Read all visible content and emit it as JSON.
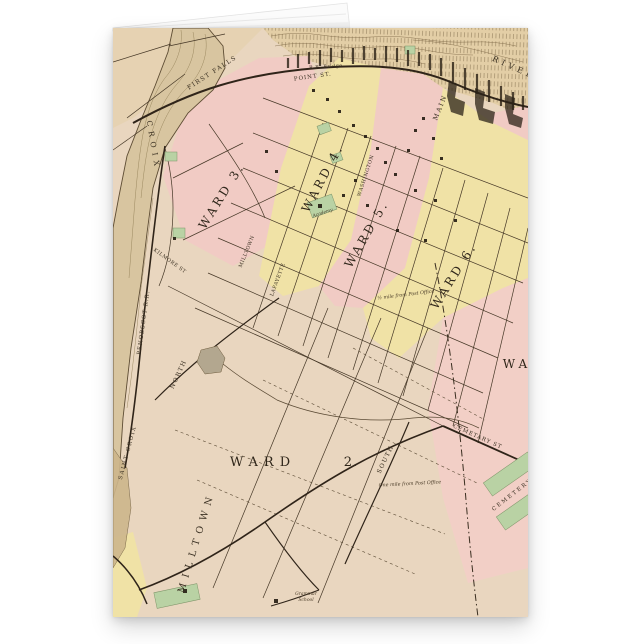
{
  "background_color": "#ffffff",
  "map": {
    "palette": {
      "parchment": "#e9d6bf",
      "river_tan": "#d8c5a0",
      "ward_pink": "#f1cbc4",
      "ward_yellow": "#f0e2a6",
      "park_green": "#b9d2a4",
      "hillside": "#e3cea6",
      "ink": "#3a2e20"
    },
    "ward_labels": [
      {
        "text": "WARD 3.",
        "x": 112,
        "y": 170,
        "rot": -58,
        "size": 12,
        "ls": 3
      },
      {
        "text": "WARD 4.",
        "x": 213,
        "y": 152,
        "rot": -62,
        "size": 12,
        "ls": 3
      },
      {
        "text": "WARD 5.",
        "x": 257,
        "y": 208,
        "rot": -60,
        "size": 12,
        "ls": 3
      },
      {
        "text": "WARD 6.",
        "x": 344,
        "y": 250,
        "rot": -58,
        "size": 12,
        "ls": 3
      },
      {
        "text": "WARD",
        "x": 150,
        "y": 438,
        "rot": 0,
        "size": 13,
        "ls": 6
      },
      {
        "text": "2.",
        "x": 238,
        "y": 438,
        "rot": 0,
        "size": 13,
        "ls": 1
      },
      {
        "text": "WA",
        "x": 404,
        "y": 340,
        "rot": 0,
        "size": 12,
        "ls": 4
      }
    ],
    "street_labels": [
      {
        "text": "CROIX",
        "x": 38,
        "y": 118,
        "rot": 80,
        "size": 7.5,
        "ls": 5
      },
      {
        "text": "SAINT CROIX",
        "x": 16,
        "y": 425,
        "rot": -75,
        "size": 5.5,
        "ls": 1.5
      },
      {
        "text": "PENOBSCOT R.R.",
        "x": 32,
        "y": 295,
        "rot": -82,
        "size": 5.5,
        "ls": 1
      },
      {
        "text": "FIRST FALLS",
        "x": 100,
        "y": 46,
        "rot": -33,
        "size": 6,
        "ls": 1.5
      },
      {
        "text": "RIVER",
        "x": 400,
        "y": 42,
        "rot": 24,
        "size": 8,
        "ls": 4
      },
      {
        "text": "POINT ST.",
        "x": 200,
        "y": 50,
        "rot": -8,
        "size": 5.5,
        "ls": 1
      },
      {
        "text": "MAIN",
        "x": 329,
        "y": 80,
        "rot": -68,
        "size": 6.5,
        "ls": 2
      },
      {
        "text": "WASHINGTON",
        "x": 254,
        "y": 148,
        "rot": -72,
        "size": 5,
        "ls": 0.5
      },
      {
        "text": "LAFAYETTE",
        "x": 166,
        "y": 252,
        "rot": -70,
        "size": 5,
        "ls": 0.5
      },
      {
        "text": "MILLTOWN",
        "x": 135,
        "y": 224,
        "rot": -68,
        "size": 5,
        "ls": 0.5
      },
      {
        "text": "KILMORE ST",
        "x": 56,
        "y": 234,
        "rot": 36,
        "size": 5,
        "ls": 0.5
      },
      {
        "text": "NORTH",
        "x": 67,
        "y": 347,
        "rot": -65,
        "size": 6,
        "ls": 1.5
      },
      {
        "text": "SOUTH",
        "x": 274,
        "y": 432,
        "rot": -64,
        "size": 6,
        "ls": 1.5
      },
      {
        "text": "MILLTOWN",
        "x": 86,
        "y": 515,
        "rot": -73,
        "size": 9.5,
        "ls": 6
      },
      {
        "text": "CEMETARY ST",
        "x": 364,
        "y": 410,
        "rot": 24,
        "size": 5.5,
        "ls": 1
      },
      {
        "text": "CEMETERY",
        "x": 400,
        "y": 468,
        "rot": -38,
        "size": 5.5,
        "ls": 2
      },
      {
        "text": "R.R. Bridge",
        "x": 213,
        "y": 40,
        "rot": -4,
        "size": 4.8,
        "ls": 0.5
      }
    ],
    "annotation_labels": [
      {
        "text": "½ mile from Post Office",
        "x": 293,
        "y": 268,
        "rot": -7,
        "size": 4.8
      },
      {
        "text": "One mile from Post Office",
        "x": 297,
        "y": 457,
        "rot": -3,
        "size": 4.8
      },
      {
        "text": "Academy",
        "x": 210,
        "y": 186,
        "rot": -18,
        "size": 4.5
      },
      {
        "text": "Grammar",
        "x": 193,
        "y": 567,
        "rot": 0,
        "size": 4.5
      },
      {
        "text": "School",
        "x": 193,
        "y": 573,
        "rot": 0,
        "size": 4.5
      }
    ]
  }
}
